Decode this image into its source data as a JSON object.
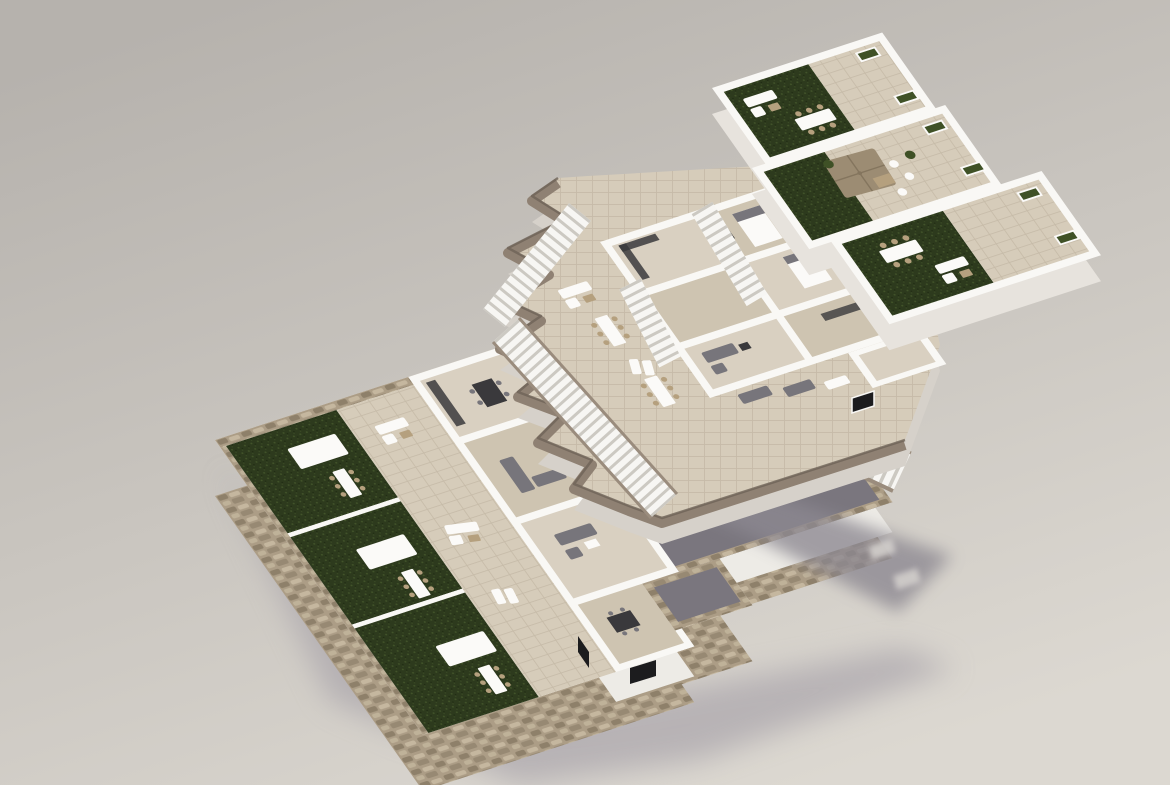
{
  "meta": {
    "title": "Axonometric 3D floor-plan rendering of a three-level residential building",
    "render_type": "architectural-visualization",
    "text_content": "none"
  },
  "scene": {
    "background": {
      "top_color": "#b6b2ad",
      "bottom_color": "#dcd8d1"
    },
    "levels": [
      {
        "id": "ground-floor",
        "label": "Ground floor on stone plinth",
        "features": [
          "rubble stone plinth and perimeter wall",
          "three private garden lawns",
          "garden dining canopies",
          "tiled terrace strip",
          "interior rooms with kitchens and sofas",
          "sunken gray courtyard",
          "stone-walled patio box",
          "dark window openings"
        ]
      },
      {
        "id": "first-floor",
        "label": "First floor slab",
        "features": [
          "organic zigzag taupe slab edge",
          "two long terraces with outdoor furniture",
          "interior rooms",
          "open-riser staircases",
          "wide exterior stair descending to courtyard",
          "black window on front face"
        ]
      },
      {
        "id": "roof-level",
        "label": "Roof terrace level",
        "features": [
          "three stepped roof terraces",
          "artificial lawn patches",
          "white outdoor dining sets with wicker chairs",
          "white lounge sofas",
          "tan parasol with seating",
          "white planters with greenery"
        ]
      }
    ],
    "lighting": {
      "sun_direction": "upper-left",
      "shadows": [
        "large soft shadow cast by first floor toward lower right with two window light slits",
        "soft ground shadow at lower right of plinth"
      ]
    }
  },
  "palette": {
    "bgTop": "#b6b2ad",
    "bgBottom": "#dcd8d1",
    "wallTop": "#f9f8f5",
    "wallLit": "#edebe6",
    "wallShade": "#d8d4ce",
    "topSide": "#e7e3dd",
    "slabSide": "#d6d1ca",
    "tile": "#d6ccba",
    "tileLine": "#c6bba8",
    "floorInt": "#d9d0c1",
    "floorIntDk": "#cec4b1",
    "grass": "#2d3a1d",
    "grassHi": "#42542a",
    "grassDk": "#1f2a12",
    "stone": "#ac9d86",
    "stoneDk": "#897b65",
    "stoneHi": "#c8bba2",
    "stoneShadow": "#6f6354",
    "taupe": "#8f8173",
    "taupeDk": "#6e6358",
    "courtyard": "#7a767e",
    "courtyardDk": "#63606a",
    "shadow": "#8c8891",
    "shadowSoft": "#a29da6",
    "lightSlit": "#d1cecb",
    "stairGap": "#ccc9c2",
    "stringer": "#9a8c7d",
    "furnDark": "#3a393c",
    "furnGray": "#77757b",
    "furnWhite": "#fbfaf8",
    "wicker": "#b5a07e",
    "parasol": "#9c8c73",
    "parasolDk": "#84755e",
    "windowGlass": "#1c1c1e",
    "plantGreen": "#3f5126"
  }
}
